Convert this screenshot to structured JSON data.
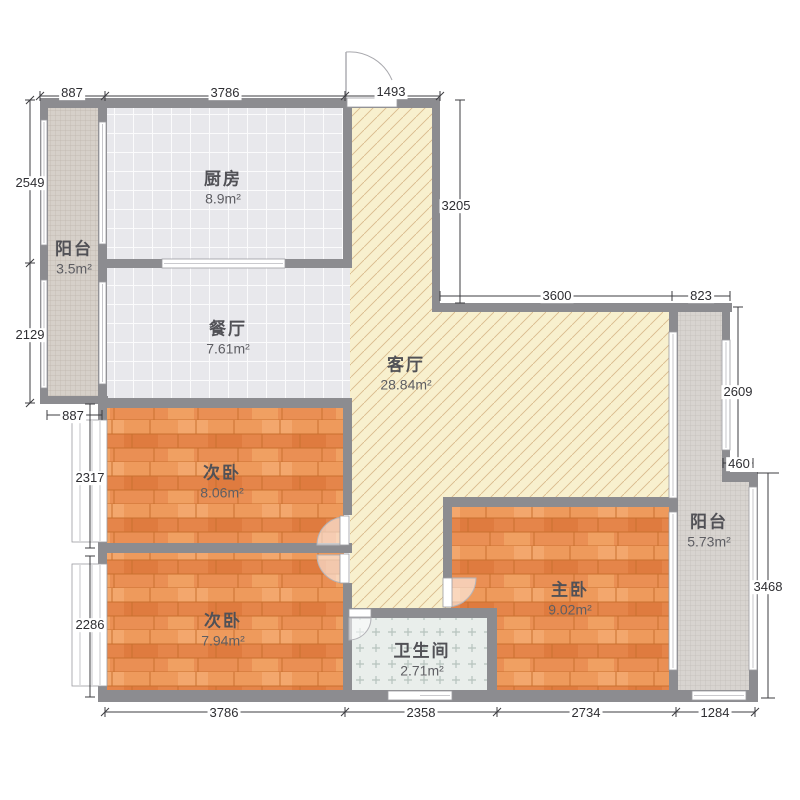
{
  "app": {
    "type": "apartment-floor-plan"
  },
  "rooms": {
    "kitchen": {
      "name": "厨房",
      "area": "8.9m²"
    },
    "balcony_left": {
      "name": "阳台",
      "area": "3.5m²"
    },
    "dining": {
      "name": "餐厅",
      "area": "7.61m²"
    },
    "living": {
      "name": "客厅",
      "area": "28.84m²"
    },
    "bedroom_upper": {
      "name": "次卧",
      "area": "8.06m²"
    },
    "bedroom_lower": {
      "name": "次卧",
      "area": "7.94m²"
    },
    "bathroom": {
      "name": "卫生间",
      "area": "2.71m²"
    },
    "master": {
      "name": "主卧",
      "area": "9.02m²"
    },
    "balcony_right": {
      "name": "阳台",
      "area": "5.73m²"
    }
  },
  "dims": {
    "top_left": "887",
    "top_mid": "3786",
    "top_entry": "1493",
    "left_upper": "2549",
    "left_mid": "2129",
    "left_balcony_w": "887",
    "left_bed1": "2317",
    "left_bed2": "2286",
    "right_entry_h": "3205",
    "right_living_w": "3600",
    "right_balcony_w": "823",
    "right_balcony_h": "2609",
    "right_step": "460",
    "right_lower_h": "3468",
    "bottom_bed": "3786",
    "bottom_bath": "2358",
    "bottom_master": "2734",
    "bottom_balcony": "1284"
  },
  "colors": {
    "wall": "#8c8c90",
    "wood_floor": "#e9904f",
    "living_floor": "#f8f0ce",
    "tile_floor": "#e8e8ec",
    "mosaic_floor": "#d8d4d0",
    "bath_floor": "#e9eeeb",
    "dim_text": "#2e2e32"
  }
}
